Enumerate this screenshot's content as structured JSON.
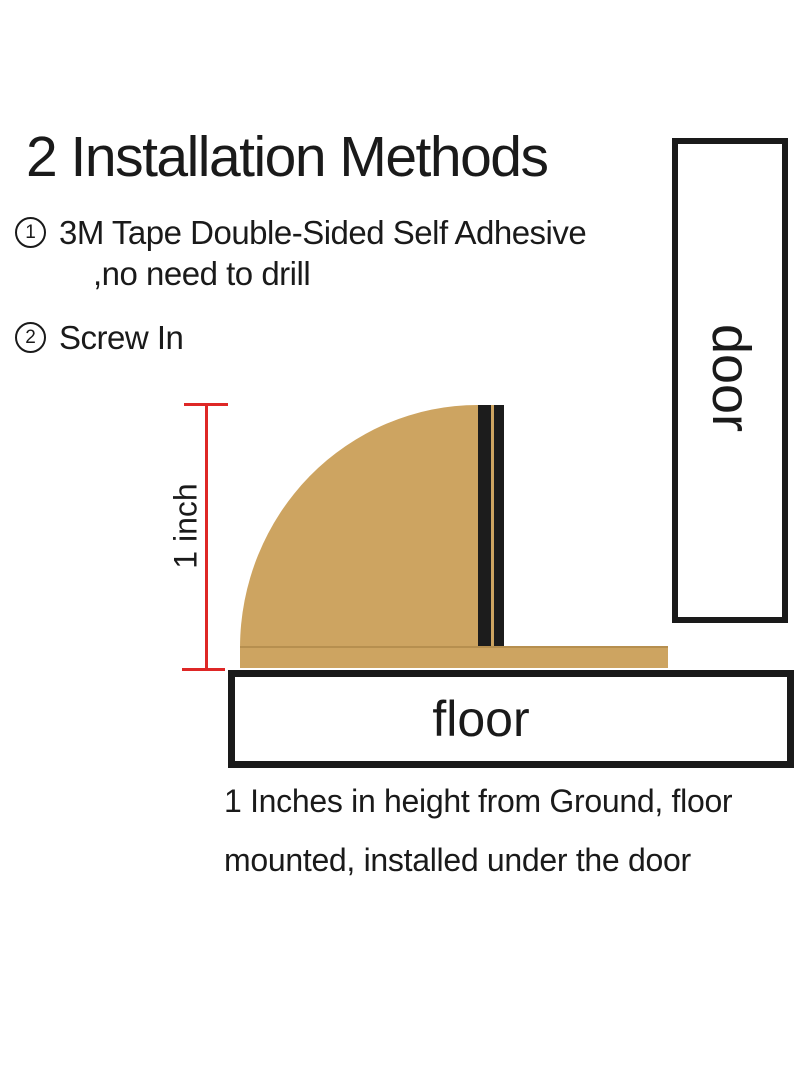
{
  "title": "2 Installation Methods",
  "methods": [
    {
      "number": "1",
      "line1": "3M Tape Double-Sided Self Adhesive",
      "line2": ",no need to drill"
    },
    {
      "number": "2",
      "line1": "Screw In"
    }
  ],
  "diagram": {
    "measurement_label": "1 inch",
    "door_label": "door",
    "floor_label": "floor"
  },
  "caption": {
    "line1": "1 Inches in height from Ground, floor",
    "line2": "mounted, installed under the door"
  },
  "colors": {
    "stopper_tan": "#cda461",
    "bumper_black": "#1c1c1c",
    "measure_red": "#de2726",
    "outline_black": "#1a1a1a"
  }
}
